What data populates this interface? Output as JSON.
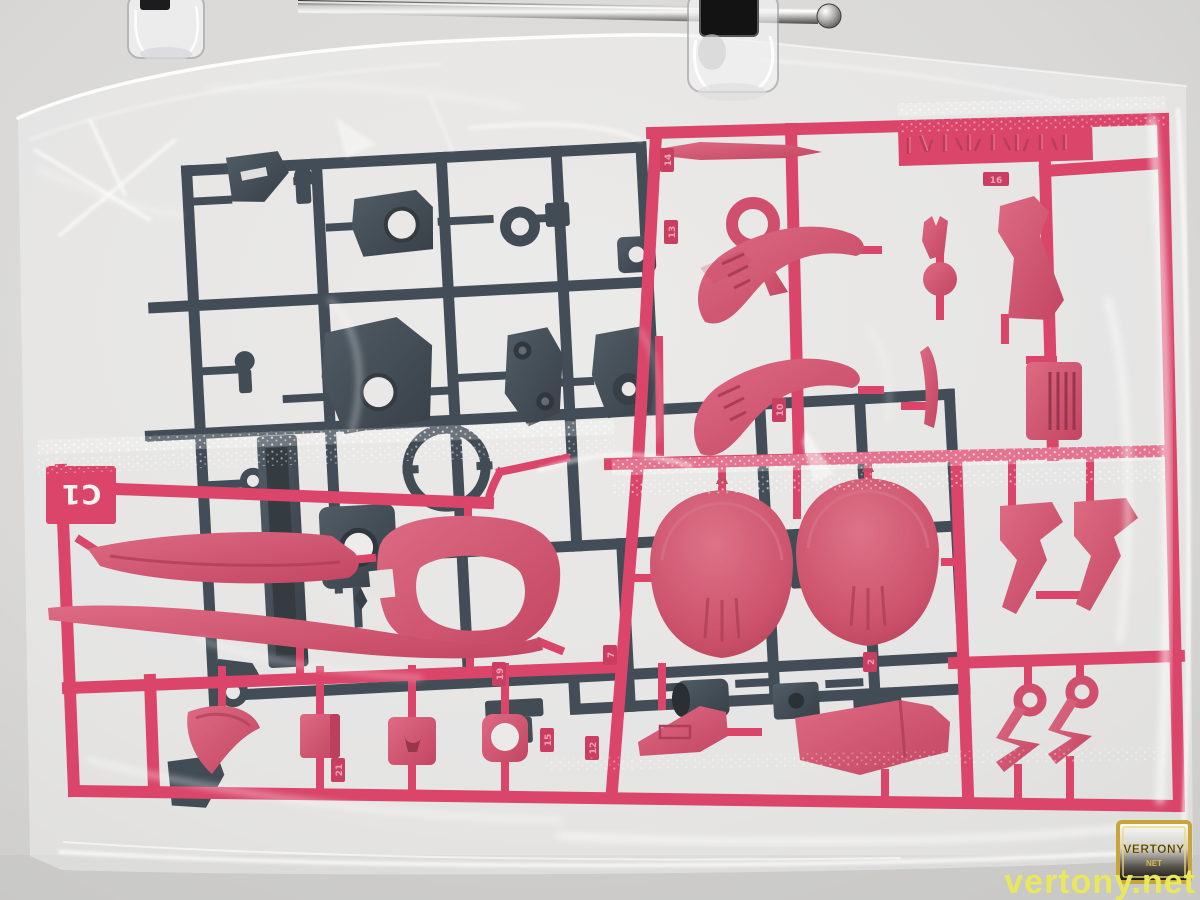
{
  "labels": {
    "runner_gate": "C1"
  },
  "part_numbers": {
    "tags": [
      "14",
      "13",
      "16",
      "10",
      "19",
      "12",
      "7",
      "15",
      "2",
      "21"
    ]
  },
  "watermark": {
    "site_text": "vertony.net",
    "badge_line1": "VERTONY",
    "badge_line2": "NET"
  },
  "colors": {
    "background": "#dcdbd9",
    "pink_runner": "#d63058",
    "pink_part": "#ce4663",
    "dark_runner": "#2e3944",
    "dark_part": "#2d3842",
    "bag_highlight": "#ffffff",
    "watermark_yellow": "#e9e75c",
    "badge_gold": "#c9a43a"
  }
}
